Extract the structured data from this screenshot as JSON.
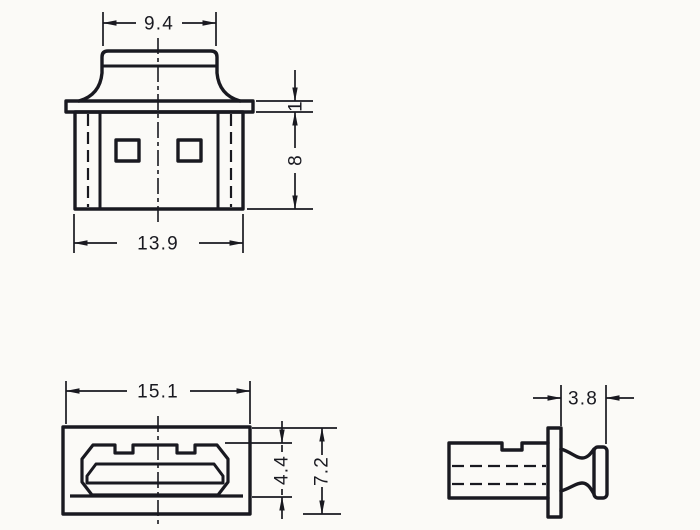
{
  "colors": {
    "line": "#191920",
    "background": "#fbfaf7"
  },
  "views": {
    "top_view": {
      "dimensions": {
        "cap_width": "9.4",
        "body_width": "13.9",
        "body_height": "8",
        "flange_thickness": "1"
      }
    },
    "front_view": {
      "dimensions": {
        "width": "15.1",
        "opening_height": "4.4",
        "overall_height": "7.2"
      }
    },
    "side_view": {
      "dimensions": {
        "knob_depth": "3.8"
      }
    }
  }
}
